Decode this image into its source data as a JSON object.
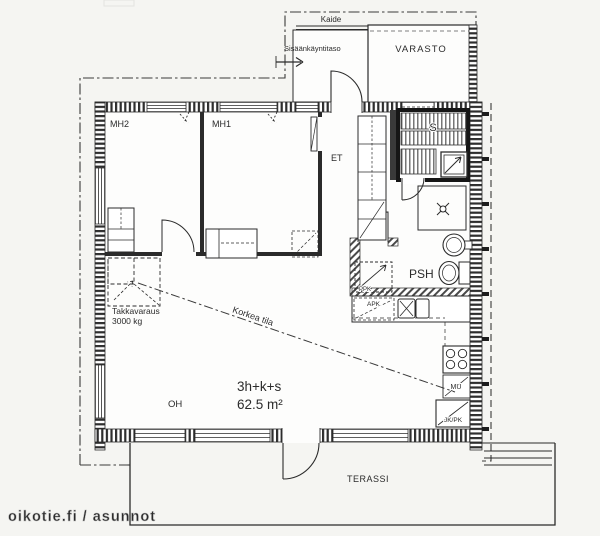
{
  "watermark": {
    "text": "oikotie.fi / asunnot"
  },
  "apartment": {
    "layout": "3h+k+s",
    "area": "62.5 m²"
  },
  "rooms": {
    "bedroom2": "MH2",
    "bedroom1": "MH1",
    "entry_hall": "ET",
    "washroom": "PSH",
    "living_room": "OH",
    "storage": "VARASTO",
    "terrace": "TERASSI",
    "entry_platform": "Sisäänkäyntitaso",
    "sauna_symbol": "S"
  },
  "annotations": {
    "railing": "Kaide",
    "high_space": "Korkea tila",
    "fireplace_line1": "Takkavaraus",
    "fireplace_line2": "3000 kg"
  },
  "appliances": {
    "washing_machine": "PPK",
    "dishwasher": "APK",
    "oven_microwave": "MU",
    "fridge_freezer": "JK/PK"
  },
  "colors": {
    "ink": "#2b2b2b",
    "wall_dark": "#161616",
    "watermark": "#d0d0d0",
    "background": "#f5f5f2"
  }
}
